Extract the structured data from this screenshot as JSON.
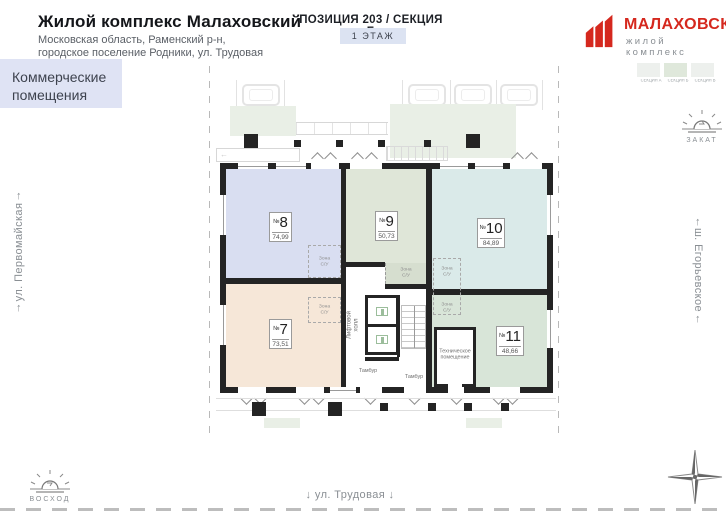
{
  "header": {
    "title": "Жилой комплекс Малаховский",
    "address_line1": "Московская область, Раменский р-н,",
    "address_line2": "городское поселение Родники, ул. Трудовая",
    "category_line1": "Коммерческие",
    "category_line2": "помещения"
  },
  "position": {
    "title": "ПОЗИЦИЯ 203 / СЕКЦИЯ Б",
    "floor_label": "1 ЭТАЖ"
  },
  "logo": {
    "name": "МАЛАХОВСКИЙ",
    "tagline": "жилой комплекс",
    "brand_red": "#d5281e"
  },
  "section_tabs": [
    {
      "label": "СЕКЦИЯ А",
      "selected": false
    },
    {
      "label": "СЕКЦИЯ Б",
      "selected": true
    },
    {
      "label": "СЕКЦИЯ В",
      "selected": false
    }
  ],
  "streets": {
    "left": "ул. Первомайская",
    "right": "ш. Егорьевское",
    "bottom": "ул. Трудовая",
    "up_arrow": "↑",
    "down_arrow": "↓"
  },
  "sun_markers": {
    "sunset": "ЗАКАТ",
    "sunrise": "ВОСХОД"
  },
  "plan": {
    "no_sign": "№",
    "rooms": [
      {
        "number": "7",
        "area": "73,51",
        "color": "#f6e7d8"
      },
      {
        "number": "8",
        "area": "74,99",
        "color": "#d9def1"
      },
      {
        "number": "9",
        "area": "50,73",
        "color": "#dfe6d8"
      },
      {
        "number": "10",
        "area": "84,89",
        "color": "#daeae9"
      },
      {
        "number": "11",
        "area": "48,66",
        "color": "#d8e5d8"
      }
    ],
    "zone_su_line1": "Зона",
    "zone_su_line2": "С/У",
    "lift_line1": "Лифтовой",
    "lift_line2": "холл",
    "tambour": "Тамбур",
    "tech_line1": "Техническое",
    "tech_line2": "помещение"
  }
}
